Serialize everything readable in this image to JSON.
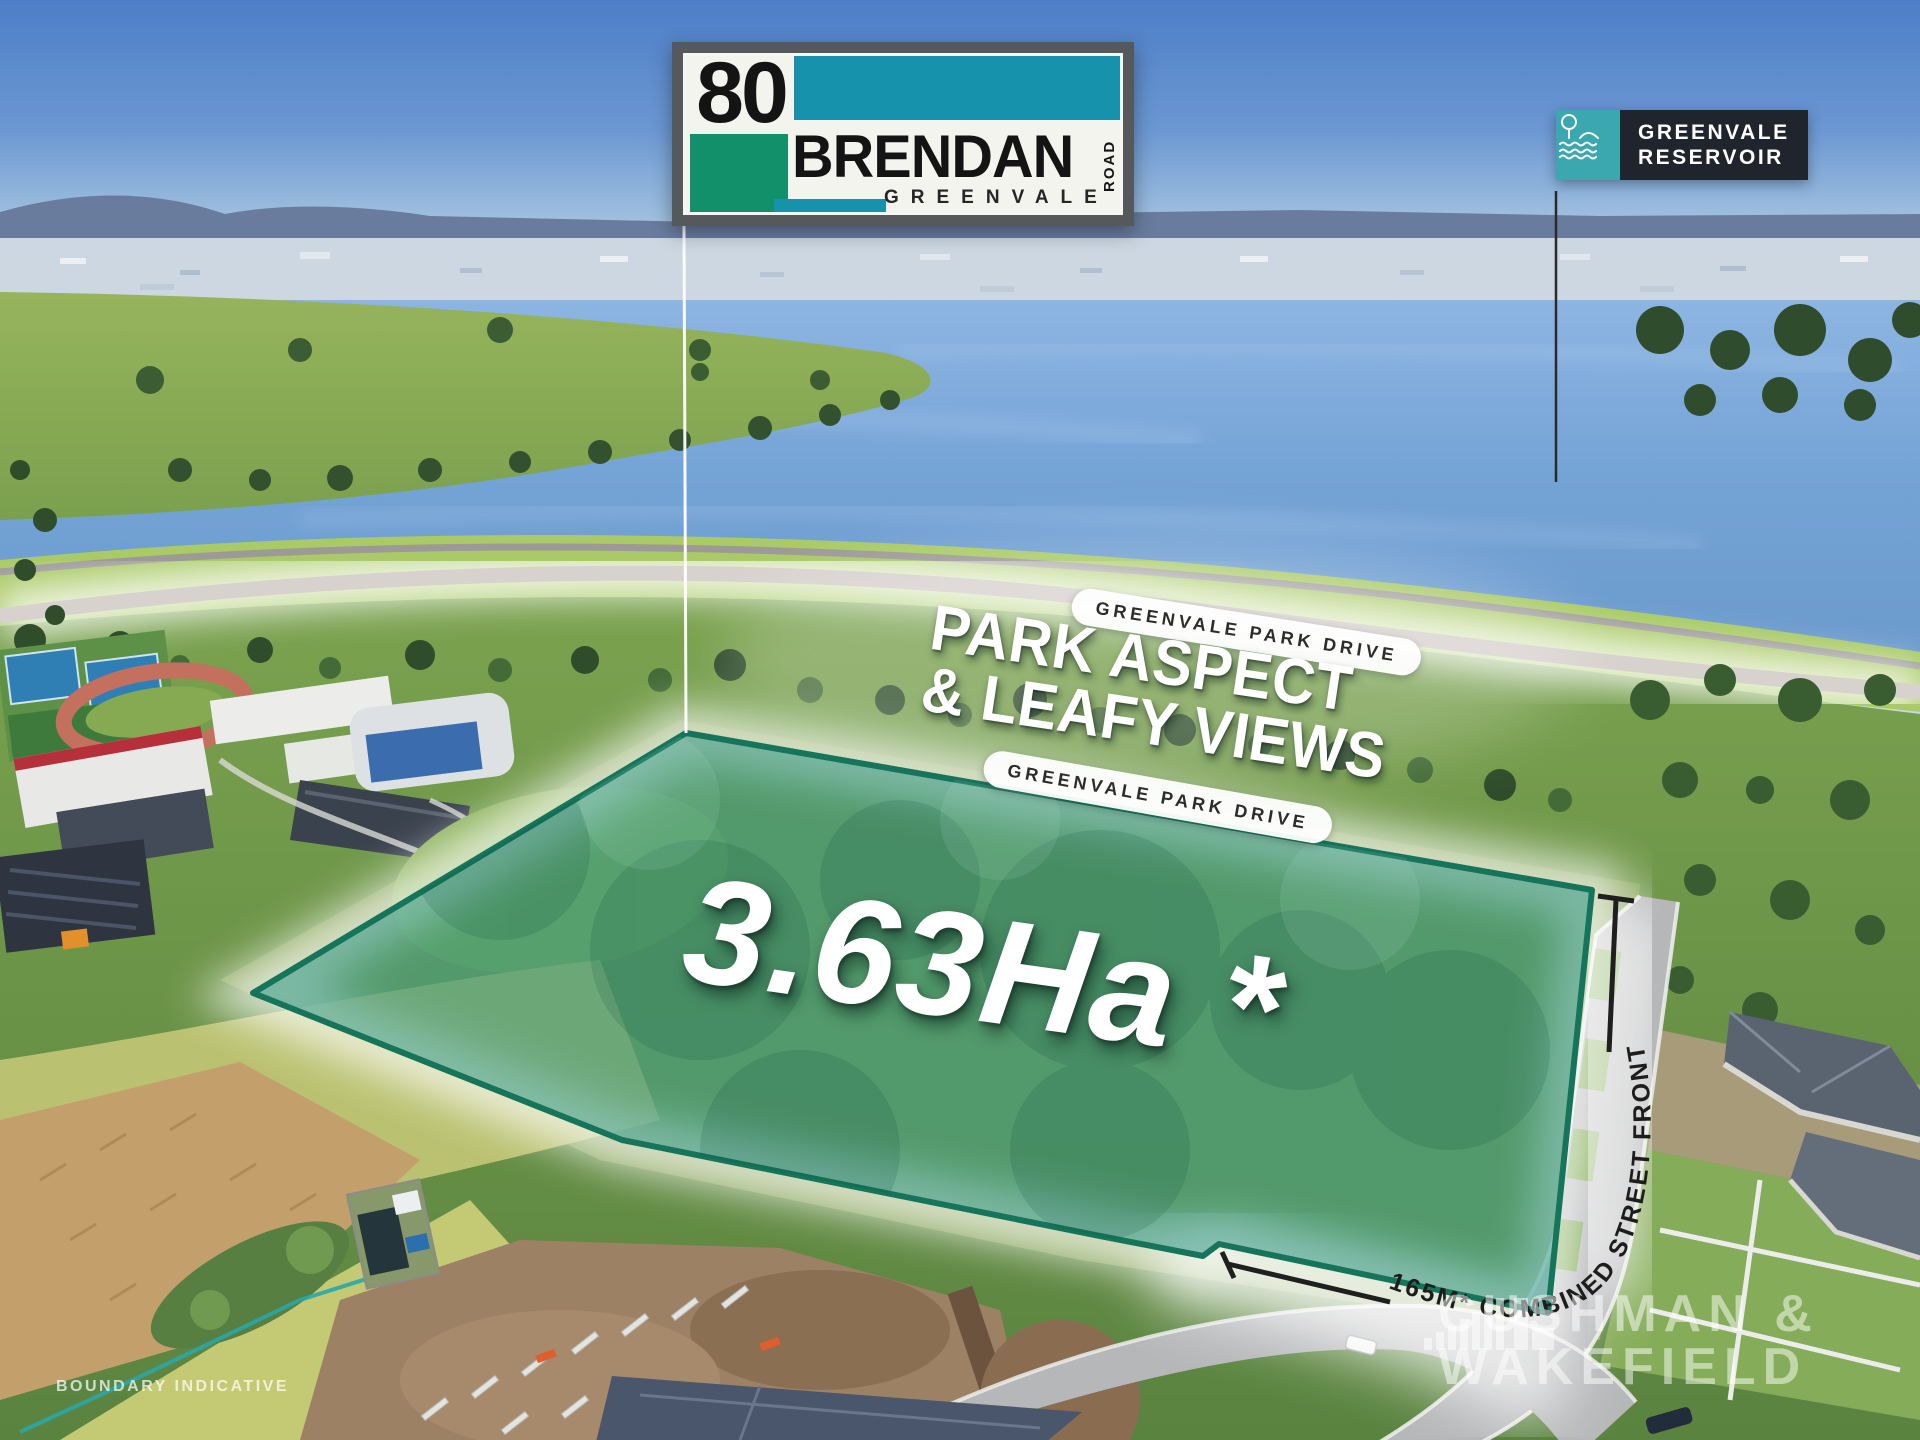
{
  "sign": {
    "number": "80",
    "street": "BRENDAN",
    "road_word": "ROAD",
    "suburb": "GREENVALE",
    "colors": {
      "teal": "#1792AD",
      "green": "#12906A",
      "frame": "#55595B"
    }
  },
  "reservoir_badge": {
    "line1": "GREENVALE",
    "line2": "RESERVOIR",
    "icon": "tree-water-icon",
    "colors": {
      "teal": "#3BA7AE",
      "dark": "#20242C"
    }
  },
  "road_labels": {
    "ribbon_top": "GREENVALE PARK DRIVE",
    "ribbon_bottom": "GREENVALE PARK DRIVE"
  },
  "headline": {
    "line1": "PARK ASPECT",
    "line2": "& LEAFY VIEWS"
  },
  "area_label": "3.63Ha *",
  "frontage_label": "165M* COMBINED STREET FRONTAGE",
  "parcel": {
    "fill": "#1E8E7E",
    "fill_opacity": 0.5,
    "stroke": "#15745A"
  },
  "watermark": {
    "line1": "CUSHMAN &",
    "line2": "WAKEFIELD",
    "icon": "bars-logo-icon"
  },
  "disclaimer": "BOUNDARY INDICATIVE"
}
